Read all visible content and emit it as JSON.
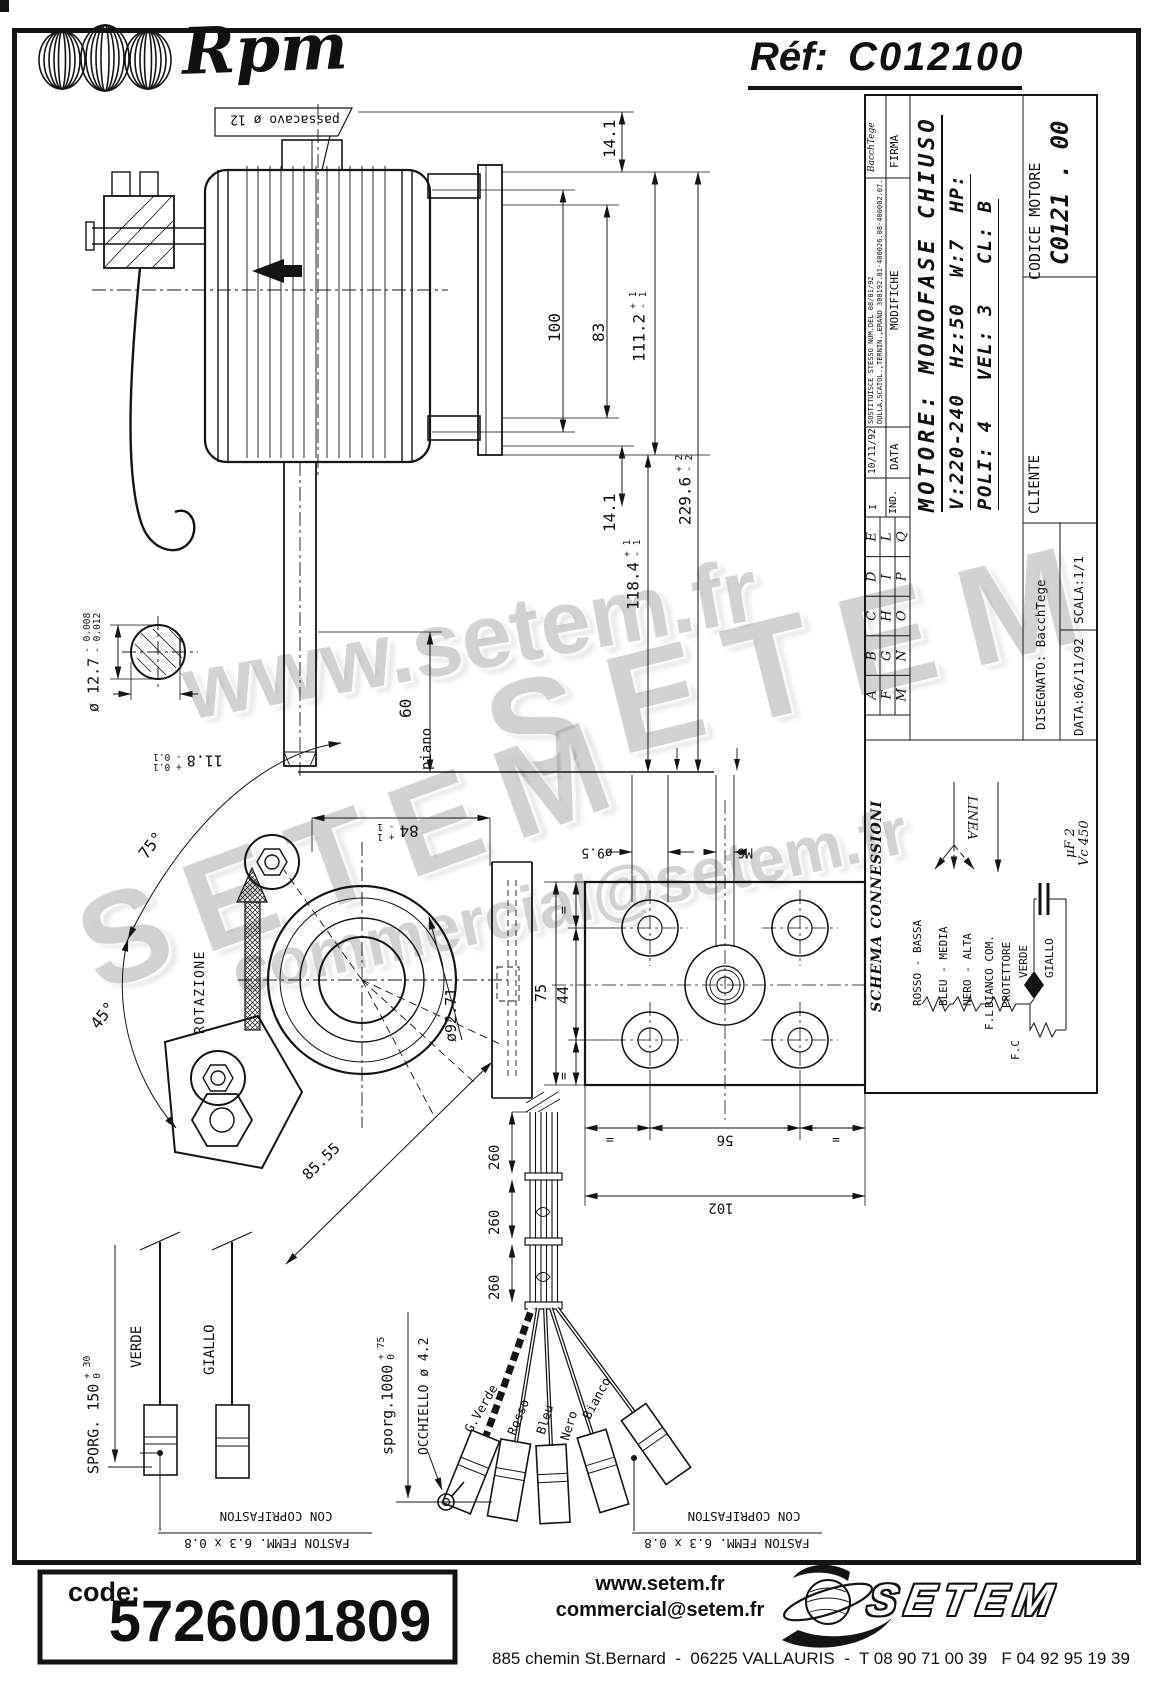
{
  "header": {
    "brand": "Rpm",
    "ref_label": "Réf:",
    "ref_value": "C012100"
  },
  "watermarks": {
    "line1": "www.setem.fr",
    "line2": "SETEM",
    "line3": "SETEM",
    "line4": "commercial@setem.fr"
  },
  "title_block": {
    "firma_value": "BacchTege",
    "firma_label": "FIRMA",
    "note1": "SOSTITUISCE STESSO NUM.DEL 08/01/92",
    "note2": "DULLA,SCATOL.,TERNIN.,ERAND 300192.01-400026.08-400002.07.",
    "modifiche_label": "MODIFICHE",
    "data_value": "10/11/92",
    "data_label": "DATA",
    "ind_value": "I",
    "ind_label": "IND.",
    "letters": [
      "A",
      "B",
      "C",
      "D",
      "E",
      "F",
      "G",
      "H",
      "I",
      "L",
      "M",
      "N",
      "O",
      "P",
      "Q"
    ],
    "motor_line1": "MOTORE: MONOFASE CHIUSO",
    "motor_line2": "V:220-240  Hz:50  W:7  HP:",
    "motor_line3": "POLI: 4   VEL: 3   CL: B",
    "codice_label": "CODICE MOTORE",
    "codice_value": "C0121 . 00",
    "cliente_label": "CLIENTE",
    "disegnato": "DISEGNATO: BacchTege",
    "scala": "SCALA:1/1",
    "data_bottom": "DATA:06/11/92"
  },
  "schema": {
    "title": "SCHEMA CONNESSIONI",
    "linea": "LINEA",
    "wire_rosso": "ROSSO - BASSA",
    "wire_bleu": "BLEU - MEDIA",
    "wire_nero": "NERO - ALTA",
    "wire_bianco": "BIANCO COM.",
    "protettore": "PROTETTORE",
    "verde": "VERDE",
    "giallo": "GIALLO",
    "fl": "F.L",
    "fc": "F.C",
    "cap_uf": "μF 2",
    "cap_vc": "Vc 450"
  },
  "side_view": {
    "passacavo_label": "passacavo ø 12",
    "dim_14_1_top": "14.1",
    "dim_100": "100",
    "dim_83": "83",
    "dim_111_2": "111.2",
    "dim_111_2_tp": "+ 1",
    "dim_111_2_tm": "- 1",
    "dim_229_6": "229.6",
    "dim_229_6_tp": "+ 2",
    "dim_229_6_tm": "- 2",
    "dim_14_1_bottom": "14.1",
    "dim_118_4": "118.4",
    "dim_118_4_tp": "+ 1",
    "dim_118_4_tm": "- 1",
    "dim_60": "60",
    "piano_label": "piano"
  },
  "shaft_section": {
    "dia": "ø 12.7",
    "dia_tp": "- 0.008",
    "dia_tm": "- 0.012",
    "flat": "11.8",
    "flat_tp": "+ 0.1",
    "flat_tm": "- 0.1"
  },
  "front_view": {
    "angle_75": "75°",
    "angle_45": "45°",
    "rotazione_label": "ROTAZIONE",
    "dim_84": "84",
    "dim_84_tp": "+ 1",
    "dim_84_tm": "- 1",
    "dia_92_71": "ø92.71",
    "dim_85_55": "85.55"
  },
  "plate_view": {
    "dia_9_5": "ø9.5",
    "m6": "M6",
    "dim_75": "75",
    "dim_44": "44",
    "eq_top": "=",
    "eq_bottom": "=",
    "eq_left": "=",
    "eq_right": "=",
    "dim_56": "56",
    "dim_102": "102"
  },
  "leads": {
    "sporg_150": "SPORG. 150",
    "sporg_150_tp": "+ 30",
    "sporg_150_tm": "0",
    "verde": "VERDE",
    "giallo": "GIALLO",
    "coprifaston_left": "CON COPRIFASTON",
    "faston_left": "FASTON FEMM. 6.3 x 0.8",
    "sporg_1000": "sporg.1000",
    "sporg_1000_tp": "+ 75",
    "sporg_1000_tm": "0",
    "occhiello": "OCCHIELLO ø 4.2",
    "dim_260_1": "260",
    "dim_260_2": "260",
    "dim_260_3": "260",
    "g_verde": "G.Verde",
    "rosso": "Rosso",
    "bleu": "Bleu",
    "nero": "Nero",
    "bianco": "Bianco",
    "coprifaston_right": "CON COPRIFASTON",
    "faston_right": "FASTON FEMM. 6.3 x 0.8"
  },
  "footer": {
    "code_label": "code:",
    "code_value": "5726001809",
    "site": "www.setem.fr",
    "email": "commercial@setem.fr",
    "brand": "SETEM",
    "address": "885 chemin St.Bernard  -  06225 VALLAURIS  -  T 08 90 71 00 39   F 04 92 95 19 39"
  }
}
